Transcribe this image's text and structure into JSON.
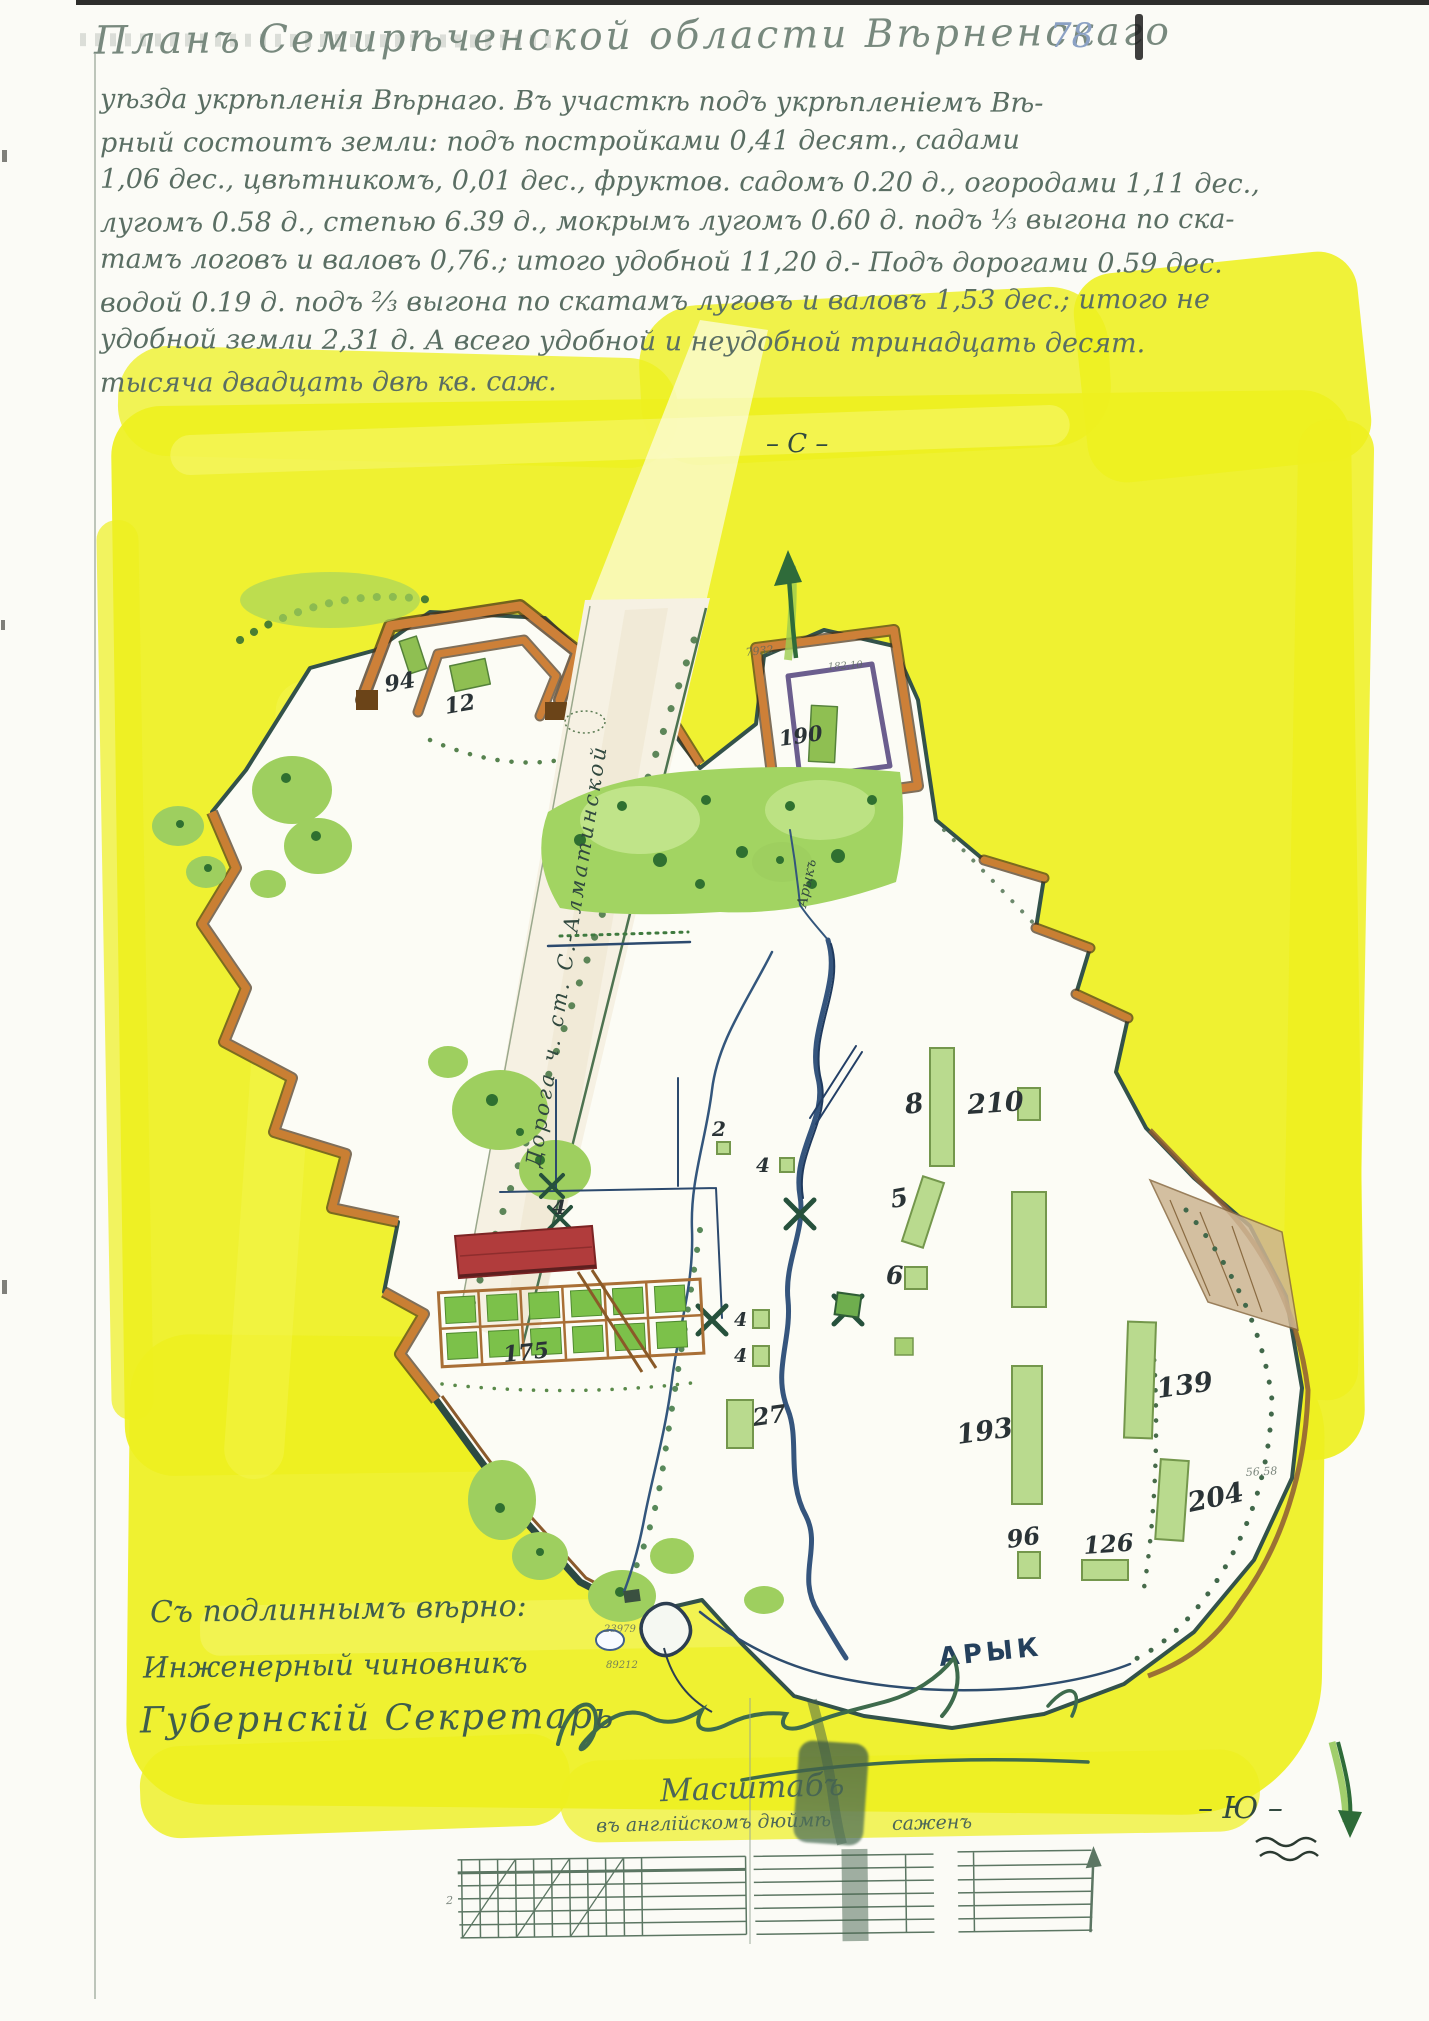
{
  "title": "Планъ Семирѣченской области Вѣрненскаго",
  "page": {
    "number": "78"
  },
  "body_lines": [
    "уѣзда укрѣпленія Вѣрнаго. Въ участкѣ подъ укрѣпленіемъ Вѣ-",
    "рный состоитъ земли: подъ постройками 0,41 десят., садами",
    "1,06 дес., цвѣтникомъ, 0,01 дес., фруктов. садомъ 0.20 д., огородами 1,11 дес.,",
    "лугомъ 0.58 д., степью 6.39 д., мокрымъ лугомъ 0.60 д. подъ ⅓ выгона по ска-",
    "тамъ логовъ и валовъ 0,76.; итого удобной 11,20 д.- Подъ дорогами 0.59 дес.",
    "водой 0.19 д. подъ ⅔ выгона по скатамъ луговъ и валовъ 1,53 дес.; итого не",
    "удобной земли 2,31 д. А всего удобной и неудобной тринадцать десят.",
    "тысяча двадцать двѣ кв. саж."
  ],
  "compass": {
    "north": "– С –",
    "south": "– Ю –"
  },
  "map": {
    "road_label": "Дорога ч. ст. С.-Алматинской",
    "canal_label_small": "Арыкъ",
    "canal_label_big": "АРЫК",
    "plot_numbers": [
      "94",
      "12",
      "190",
      "2",
      "4",
      "5",
      "6",
      "8",
      "210",
      "4",
      "4",
      "27",
      "193",
      "139",
      "204",
      "96",
      "126",
      "4",
      "175"
    ],
    "micro_notes": [
      "7932",
      "182.10",
      "23979",
      "89212",
      "56.58"
    ]
  },
  "certification": {
    "line1": "Съ подлиннымъ вѣрно:",
    "line2": "Инженерный чиновникъ",
    "line3": "Губернскій Секретарь"
  },
  "scale": {
    "title": "Масштабъ",
    "caption_left": "въ англійскомъ дюймѣ",
    "caption_right": "саженъ",
    "tiny_mark": "2"
  }
}
